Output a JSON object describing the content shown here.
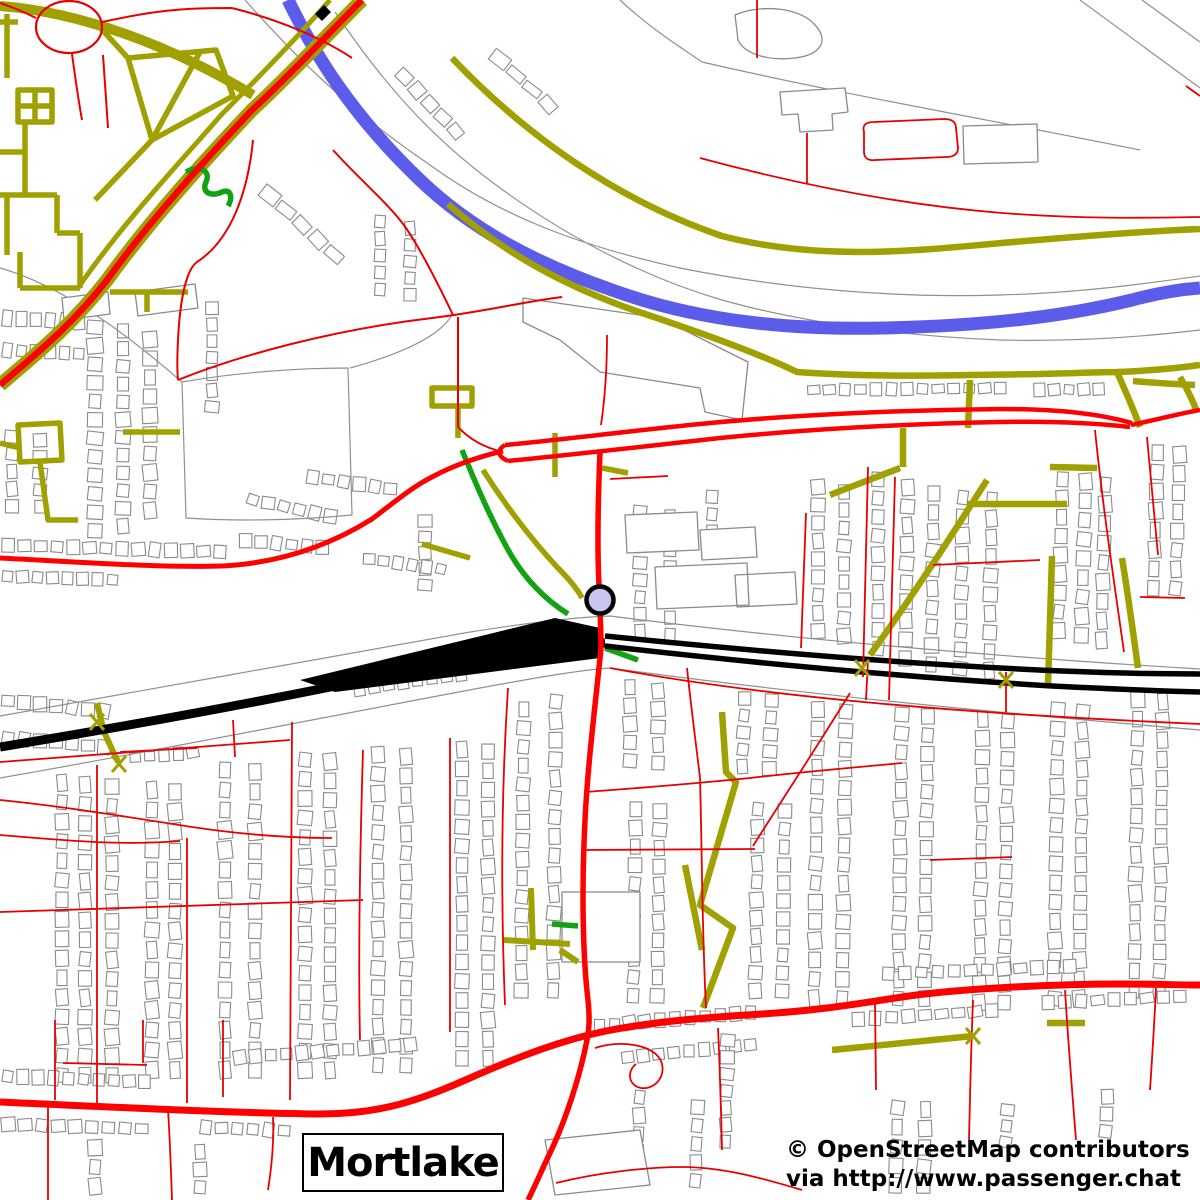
{
  "map": {
    "place_label": "Mortlake",
    "attribution_line1": "© OpenStreetMap contributors",
    "attribution_line2": "via http://www.passenger.chat",
    "colors": {
      "bg": "#ffffff",
      "olive": "#a0a000",
      "red": "#e80000",
      "redBold": "#ff0000",
      "green": "#12a312",
      "blue": "#5c5cea",
      "black": "#000000",
      "gray": "#909090",
      "bldg": "#8a8a8a",
      "stationFill": "#c6c6f1"
    },
    "station": {
      "name": "railway-station-marker",
      "cx": 600,
      "cy": 600,
      "r": 13.5,
      "ring": 4.5
    },
    "features": [
      {
        "n": "boundary-lines",
        "c": "gray",
        "w": 1.2,
        "d": "M0,268 C60,285 122,330 182,382 M182,382 C240,372 300,368 348,368 L352,515 C290,521 230,521 186,518 Z M350,368 C415,350 442,332 452,315 M620,0 C652,30 682,48 702,62 M702,62 C850,96 1002,122 1140,150 M1080,0 L1200,88 M1142,0 L1200,42"
      },
      {
        "n": "river-bank-lines",
        "c": "gray",
        "w": 1.2,
        "d": "M245,0 C300,62 352,112 430,165 C500,216 580,246 680,268 C790,290 900,298 1000,295 C1080,293 1150,283 1200,276 M335,12 C382,82 430,136 492,182 C560,233 640,276 722,300 C800,322 900,336 1000,340 C1080,342 1150,336 1200,330"
      },
      {
        "n": "railway-corridor-lines",
        "c": "gray",
        "w": 1.2,
        "d": "M0,716 C150,690 320,658 470,632 C540,621 580,617 610,616 C800,640 1000,657 1200,669 M0,778 C150,752 320,718 480,688 C545,676 582,670 610,668 C800,694 1000,713 1200,730"
      },
      {
        "n": "large-buildings",
        "c": "bldg",
        "w": 1.3,
        "f": "#ffffff",
        "d": "M523,298 L660,318 L748,362 L742,420 L705,412 L700,388 L600,372 L560,340 L523,322 Z M625,515 L697,512 L699,550 L627,553 Z M655,567 L747,563 L749,605 L657,609 Z M562,892 L640,892 L640,962 L562,962 Z M963,126 L1037,124 L1038,162 L964,164 Z M780,92 L845,88 L848,112 L832,114 L833,130 L800,132 L798,114 L782,115 Z M135,292 L195,284 L198,308 L138,316 Z M62,298 L108,292 L110,314 L64,320 Z M700,530 L755,527 L757,557 L702,560 Z M735,575 L795,572 L797,604 L737,607 Z M545,1140 L640,1130 L650,1185 L555,1195 Z M735,15 C760,4 800,7 815,25 C830,41 820,55 795,58 C770,61 745,55 738,40 Z"
      },
      {
        "n": "river-thames",
        "c": "blue",
        "w": 13,
        "d": "M288,0 C315,55 352,115 420,180 C470,228 532,262 612,290 C700,322 792,330 882,328 C982,326 1062,317 1132,300 C1162,292 1186,289 1200,288"
      },
      {
        "n": "olive-grid-northwest",
        "c": "olive",
        "w": 5.5,
        "d": "M7,14 L7,78 M0,22 L18,22 M18,90 L52,90 L52,122 L18,122 Z M18,106 L52,106 M35,90 L35,122 M25,122 L25,195 M0,152 L25,152 M7,195 L7,255 M0,195 L57,195 M57,195 L57,233 M57,233 L80,233 M80,233 L80,288 M20,288 L80,288 M20,252 L20,288 M128,58 L216,50 L233,96 L152,140 Z M152,140 L200,52 M128,58 L95,22 M152,140 L95,200 M110,292 L188,292 M147,292 L147,312 M123,432 L180,432 M18,425 L60,423 L62,460 L20,462 Z M40,462 L48,520 L78,520 M0,443 L20,448"
      },
      {
        "n": "main-road-a316-casing",
        "c": "olive",
        "w": 14,
        "d": "M362,0 C322,40 290,75 252,110 C205,160 152,218 107,280 C72,325 35,355 0,385"
      },
      {
        "n": "branch-road-casing",
        "c": "olive",
        "w": 10,
        "d": "M0,6 C80,12 170,45 253,95"
      },
      {
        "n": "service-road-parallel",
        "c": "olive",
        "w": 5,
        "d": "M330,0 C295,40 258,78 222,114 C175,168 122,224 78,288"
      },
      {
        "n": "riverside-towpaths",
        "c": "olive",
        "w": 6.5,
        "d": "M452,58 C530,140 622,202 722,236 C822,262 922,250 1002,243 C1082,236 1150,231 1200,229 M448,204 C500,250 562,286 642,313 C702,333 762,355 797,372 C880,378 960,375 1040,374 C1080,373 1100,372 1117,372 C1145,371 1180,368 1200,365 M1117,372 C1125,390 1133,408 1140,427 M1133,381 C1155,383 1175,384 1195,385 M1180,377 C1187,389 1193,401 1197,412 M970,380 L968,428"
      },
      {
        "n": "park-paths-central",
        "c": "olive",
        "w": 5.5,
        "d": "M432,388 l40,0 l0,18 l-40,0 Z M458,405 L458,438 M483,470 C505,505 532,540 557,567 C570,580 578,590 582,598 M470,558 L422,544 M555,433 L555,477 M602,468 L628,473 M535,654 L562,660"
      },
      {
        "n": "olive-streets-northeast",
        "c": "olive",
        "w": 6.5,
        "d": "M830,495 C855,485 880,476 900,468 M903,467 L903,428 M967,504 L1067,504 M987,480 C950,538 912,597 870,655 M1052,556 L1048,686 M1122,558 C1128,595 1133,631 1138,668 M1050,467 L1097,468"
      },
      {
        "n": "olive-paths-southeast",
        "c": "olive",
        "w": 6.5,
        "d": "M722,712 L726,772 L736,782 L700,905 L733,928 L703,1008 M685,865 L702,950 M832,1050 L973,1036 M1047,1023 L1085,1023"
      },
      {
        "n": "olive-paths-southwest",
        "c": "olive",
        "w": 6,
        "d": "M503,940 L570,944 M531,888 L533,950 M560,950 L578,962 M97,703 L104,732 L118,762"
      },
      {
        "n": "green-footpaths",
        "c": "green",
        "w": 5.5,
        "d": "M186,172 C200,164 211,171 206,182 C201,193 212,197 222,192 C231,188 233,198 228,206 M462,450 C475,482 491,520 511,555 C526,580 546,600 568,614 M605,648 L638,660 M552,924 L578,926"
      },
      {
        "n": "railway-main-west",
        "c": "black",
        "w": 9,
        "d": "M0,747 C140,724 282,698 422,668 C482,656 542,648 605,643"
      },
      {
        "n": "railway-sidings",
        "c": "black",
        "w": 0,
        "f": "#000000",
        "d": "M300,680 L555,618 L600,628 L600,658 L335,692 Z"
      },
      {
        "n": "railway-tracks-east",
        "c": "black",
        "w": 5.5,
        "d": "M605,636 C762,652 922,665 1062,671 C1112,673 1162,674 1200,674 M605,646 C762,664 922,678 1052,686 C1112,689 1162,691 1200,692"
      },
      {
        "n": "bridge-mark",
        "c": "black",
        "w": 0,
        "f": "#000000",
        "d": "M315,14 L324,5 L331,12 L322,21 Z"
      },
      {
        "n": "roundabout",
        "c": "red",
        "w": 2.2,
        "d": "M36,27 A33,26 0 1 0 102,27 A33,26 0 1 0 36,27"
      },
      {
        "n": "red-streets-northwest",
        "c": "red",
        "w": 2,
        "d": "M103,55 L108,128 M253,140 C248,192 231,240 197,262 C186,270 180,300 178,340 C177,360 177,370 178,380 M178,380 C240,355 332,330 432,318 C482,312 522,302 562,297 M333,150 C360,180 391,206 406,228 C421,250 441,290 453,315 M458,317 L458,427 M458,427 C470,440 486,448 503,452 M232,8 C280,20 322,38 352,58 M102,22 C125,17 150,12 175,10 C195,8 215,8 232,8 M72,54 C75,76 78,98 82,120 M36,18 C24,12 12,7 0,3"
      },
      {
        "n": "red-boundary-northeast",
        "c": "red",
        "w": 1.8,
        "d": "M700,158 C800,185 902,205 1002,213 C1082,219 1142,218 1200,217 M807,133 L807,183 M864,132 C862,125 866,122 874,122 L944,119 C952,119 956,122 956,128 L958,148 C958,154 954,157 946,157 L876,160 C868,161 864,158 864,152 Z M757,0 L757,58 M1186,86 L1200,96"
      },
      {
        "n": "red-streets-northeast",
        "c": "red",
        "w": 1.8,
        "d": "M806,513 L801,648 M868,467 L863,677 M895,477 L889,700 M1095,430 C1102,500 1113,575 1124,652 M1147,437 L1158,555 M933,565 L1040,560 M1140,597 L1185,598 M610,479 L668,476 M601,425 C605,398 607,365 607,335 M868,660 L866,700 M1006,672 L1006,712"
      },
      {
        "n": "red-rail-parallel-road",
        "c": "red",
        "w": 1.8,
        "d": "M610,668 C760,696 950,713 1200,724"
      },
      {
        "n": "red-streets-southwest",
        "c": "red",
        "w": 1.8,
        "d": "M97,765 L97,1103 M187,838 L187,1103 M233,720 L235,757 M292,722 L290,1100 M363,750 C360,850 358,950 360,1040 M450,738 L450,1032 M508,688 C502,780 500,880 505,1005 M120,752 L197,748 M0,800 C60,806 122,816 192,827 C232,833 282,838 332,838 M0,835 C60,840 120,846 180,841 M0,912 C120,908 250,904 363,900 M0,762 C100,754 200,746 290,740"
      },
      {
        "n": "red-streets-southcentral",
        "c": "red",
        "w": 1.8,
        "d": "M585,792 C640,788 700,783 750,778 C800,772 860,767 902,763 M585,850 L755,849 M687,668 C692,715 698,760 700,778 M700,778 C702,850 702,930 706,1008 M850,693 C820,742 782,800 753,846 M595,1048 C620,1040 650,1044 660,1059 C668,1074 656,1090 641,1088 C629,1086 626,1072 636,1064 M556,1183 C600,1172 650,1167 682,1167 C722,1167 762,1178 802,1190 M718,1028 C720,1070 721,1110 722,1150"
      },
      {
        "n": "red-streets-southeast",
        "c": "red",
        "w": 1.8,
        "d": "M875,1000 L876,1090 M973,1000 C971,1050 970,1095 969,1140 M1065,990 C1068,1040 1072,1090 1076,1140 M1156,988 C1154,1030 1152,1060 1150,1090 M55,1020 L55,1100 M143,1020 L143,1063 M223,1020 L223,1097 M48,1103 L48,1200 M168,1110 C170,1140 171,1170 172,1200 M273,1117 C274,1140 272,1165 268,1190 M63,1063 L147,1065 M930,860 L1012,857"
      },
      {
        "n": "road-lower-richmond",
        "c": "redBold",
        "w": 5,
        "d": "M0,558 C80,562 160,568 222,566 C282,563 332,544 372,519 C392,504 412,487 432,477 C456,464 482,456 503,451"
      },
      {
        "n": "road-mortlake-high-loop",
        "c": "redBold",
        "w": 4.5,
        "d": "M505,445 C560,440 620,432 700,424 C790,415 900,410 1000,409 C1060,409 1100,414 1132,423 M508,461 C570,455 640,447 720,438 C800,430 900,424 1000,422 C1050,421 1095,423 1130,427 M505,445 C497,450 497,456 508,461 M1131,425 C1155,420 1178,414 1200,410"
      },
      {
        "n": "road-sheen-lane",
        "c": "redBold",
        "w": 5.5,
        "d": "M600,452 C598,500 597,545 599,585 C600,612 601,628 601,648 C596,700 588,760 585,820 C582,880 582,950 588,1000 C590,1020 589,1030 587,1040 C580,1076 566,1120 549,1155 C541,1172 534,1188 528,1200"
      },
      {
        "n": "road-a205-south-circular",
        "c": "redBold",
        "w": 7,
        "d": "M0,1102 C110,1107 230,1113 320,1114 C382,1114 420,1100 470,1078 C520,1056 562,1040 606,1031 C652,1022 700,1018 746,1015 C820,1011 862,1003 902,997 C962,988 1060,984 1122,984 C1150,984 1180,985 1200,985"
      },
      {
        "n": "road-a316-centreline",
        "c": "redBold",
        "w": 6.5,
        "d": "M362,0 C322,40 290,75 252,110 C205,160 152,218 107,280 C72,325 35,355 0,385"
      },
      {
        "n": "level-crossing-marks",
        "c": "olive",
        "w": 3,
        "d": "M90,714 L104,730 M104,714 L90,730 M112,756 L126,772 M126,756 L112,772 M855,660 L869,676 M869,660 L855,676 M999,672 L1013,688 M1013,672 L999,688 M966,1028 L980,1044 M980,1028 L966,1044"
      }
    ],
    "house_strips": [
      [
        95,
        318,
        95,
        540,
        12,
        14
      ],
      [
        123,
        322,
        123,
        535,
        12,
        13
      ],
      [
        150,
        330,
        150,
        520,
        10,
        13
      ],
      [
        212,
        300,
        212,
        415,
        7,
        12
      ],
      [
        262,
        188,
        342,
        262,
        5,
        13
      ],
      [
        398,
        70,
        462,
        138,
        5,
        12
      ],
      [
        492,
        52,
        556,
        112,
        4,
        11
      ],
      [
        0,
        318,
        86,
        322,
        6,
        14
      ],
      [
        0,
        350,
        86,
        354,
        6,
        13
      ],
      [
        12,
        428,
        12,
        515,
        5,
        12
      ],
      [
        40,
        432,
        40,
        515,
        5,
        12
      ],
      [
        0,
        545,
        228,
        552,
        14,
        13
      ],
      [
        0,
        576,
        120,
        580,
        8,
        12
      ],
      [
        238,
        540,
        330,
        548,
        6,
        12
      ],
      [
        245,
        498,
        338,
        518,
        6,
        12
      ],
      [
        305,
        476,
        398,
        490,
        6,
        12
      ],
      [
        380,
        213,
        380,
        298,
        5,
        12
      ],
      [
        410,
        220,
        410,
        303,
        5,
        12
      ],
      [
        425,
        513,
        425,
        593,
        5,
        12
      ],
      [
        362,
        558,
        448,
        570,
        6,
        12
      ],
      [
        640,
        503,
        640,
        640,
        8,
        12
      ],
      [
        670,
        508,
        670,
        643,
        8,
        12
      ],
      [
        712,
        488,
        712,
        558,
        4,
        12
      ],
      [
        818,
        478,
        818,
        640,
        9,
        12
      ],
      [
        844,
        483,
        844,
        645,
        9,
        12
      ],
      [
        878,
        470,
        878,
        658,
        10,
        12
      ],
      [
        908,
        478,
        905,
        668,
        10,
        12
      ],
      [
        934,
        484,
        931,
        674,
        10,
        12
      ],
      [
        963,
        488,
        960,
        678,
        10,
        12
      ],
      [
        992,
        490,
        989,
        680,
        10,
        12
      ],
      [
        1063,
        470,
        1058,
        640,
        9,
        12
      ],
      [
        1086,
        472,
        1081,
        645,
        9,
        12
      ],
      [
        1106,
        475,
        1101,
        650,
        9,
        12
      ],
      [
        1158,
        443,
        1153,
        598,
        8,
        12
      ],
      [
        1180,
        445,
        1175,
        598,
        8,
        12
      ],
      [
        806,
        390,
        1008,
        388,
        13,
        11
      ],
      [
        1032,
        390,
        1106,
        389,
        5,
        11
      ],
      [
        62,
        773,
        62,
        1085,
        16,
        12
      ],
      [
        85,
        775,
        85,
        1085,
        16,
        12
      ],
      [
        112,
        777,
        112,
        1085,
        16,
        12
      ],
      [
        152,
        780,
        152,
        1080,
        15,
        12
      ],
      [
        175,
        782,
        175,
        1080,
        15,
        12
      ],
      [
        225,
        760,
        225,
        1080,
        16,
        12
      ],
      [
        255,
        762,
        255,
        1080,
        16,
        12
      ],
      [
        305,
        750,
        305,
        1080,
        17,
        12
      ],
      [
        330,
        752,
        330,
        1080,
        17,
        12
      ],
      [
        378,
        745,
        378,
        1075,
        17,
        12
      ],
      [
        406,
        747,
        406,
        1075,
        17,
        12
      ],
      [
        462,
        740,
        462,
        1068,
        17,
        12
      ],
      [
        488,
        742,
        488,
        1068,
        17,
        12
      ],
      [
        524,
        700,
        521,
        1000,
        16,
        12
      ],
      [
        556,
        692,
        553,
        1000,
        16,
        12
      ],
      [
        0,
        700,
        112,
        712,
        7,
        13
      ],
      [
        0,
        737,
        112,
        748,
        7,
        12
      ],
      [
        352,
        690,
        468,
        673,
        8,
        12
      ],
      [
        128,
        758,
        200,
        752,
        5,
        11
      ],
      [
        630,
        678,
        630,
        770,
        5,
        12
      ],
      [
        658,
        682,
        658,
        772,
        5,
        12
      ],
      [
        636,
        800,
        633,
        1005,
        11,
        12
      ],
      [
        660,
        802,
        657,
        1005,
        11,
        12
      ],
      [
        745,
        690,
        742,
        775,
        5,
        12
      ],
      [
        772,
        692,
        769,
        777,
        5,
        12
      ],
      [
        758,
        800,
        755,
        1000,
        11,
        12
      ],
      [
        785,
        802,
        782,
        1000,
        11,
        12
      ],
      [
        818,
        700,
        814,
        1008,
        16,
        12
      ],
      [
        846,
        702,
        842,
        1008,
        16,
        12
      ],
      [
        902,
        705,
        898,
        1008,
        16,
        12
      ],
      [
        928,
        707,
        924,
        1008,
        16,
        12
      ],
      [
        983,
        710,
        979,
        1012,
        16,
        12
      ],
      [
        1008,
        712,
        1004,
        1012,
        16,
        12
      ],
      [
        1058,
        700,
        1054,
        1008,
        16,
        12
      ],
      [
        1083,
        702,
        1079,
        1008,
        16,
        12
      ],
      [
        1138,
        690,
        1134,
        1000,
        16,
        12
      ],
      [
        1163,
        692,
        1159,
        1000,
        16,
        12
      ],
      [
        0,
        1076,
        152,
        1082,
        10,
        13
      ],
      [
        232,
        1058,
        418,
        1044,
        12,
        13
      ],
      [
        592,
        1026,
        758,
        1012,
        11,
        13
      ],
      [
        880,
        974,
        1078,
        966,
        12,
        12
      ],
      [
        0,
        1124,
        150,
        1129,
        9,
        12
      ],
      [
        198,
        1127,
        292,
        1131,
        6,
        12
      ],
      [
        620,
        1058,
        758,
        1044,
        9,
        12
      ],
      [
        850,
        1020,
        1000,
        1010,
        9,
        12
      ],
      [
        1040,
        1003,
        1188,
        996,
        9,
        12
      ],
      [
        95,
        1138,
        95,
        1196,
        3,
        12
      ],
      [
        200,
        1143,
        200,
        1196,
        3,
        12
      ],
      [
        640,
        1088,
        637,
        1180,
        5,
        12
      ],
      [
        698,
        1098,
        695,
        1190,
        5,
        12
      ],
      [
        728,
        1032,
        725,
        1150,
        7,
        12
      ],
      [
        898,
        1098,
        895,
        1195,
        5,
        12
      ],
      [
        926,
        1100,
        923,
        1195,
        5,
        12
      ],
      [
        1008,
        1102,
        1005,
        1150,
        3,
        12
      ],
      [
        1108,
        1088,
        1105,
        1140,
        3,
        12
      ]
    ]
  }
}
